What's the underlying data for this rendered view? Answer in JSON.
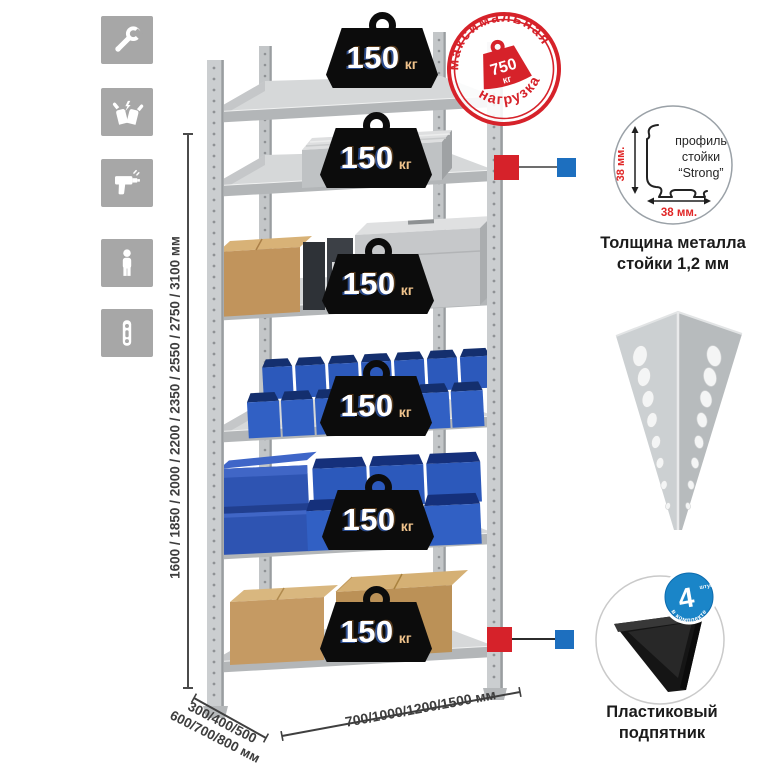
{
  "sidebar": {
    "icons": [
      "wrench-icon",
      "gloves-icon",
      "drill-icon",
      "person-icon",
      "rack-post-icon"
    ]
  },
  "dimensions": {
    "height_label": "1600 / 1850 / 2000 / 2200 / 2350 / 2550 / 2750 / 3100 мм",
    "depth_label_line1": "300/400/500",
    "depth_label_line2": "600/700/800 мм",
    "width_label": "700/1000/1200/1500 мм"
  },
  "rack": {
    "shelves": 6,
    "weights": [
      {
        "value": "150",
        "unit": "кг"
      },
      {
        "value": "150",
        "unit": "кг"
      },
      {
        "value": "150",
        "unit": "кг"
      },
      {
        "value": "150",
        "unit": "кг"
      },
      {
        "value": "150",
        "unit": "кг"
      },
      {
        "value": "150",
        "unit": "кг"
      }
    ]
  },
  "stamp": {
    "arc_top": "максимальная",
    "arc_bottom": "нагрузка",
    "value": "750",
    "unit": "кг"
  },
  "profile_detail": {
    "label_line1": "профиль",
    "label_line2": "стойки",
    "label_line3": "“Strong”",
    "dim_vertical": "38 мм.",
    "dim_horizontal": "38 мм.",
    "caption_line1": "Толщина металла",
    "caption_line2": "стойки 1,2 мм"
  },
  "foot_detail": {
    "badge_value": "4",
    "badge_unit": "штуки",
    "badge_arc": "в комплекте",
    "caption_line1": "Пластиковый",
    "caption_line2": "подпятник"
  },
  "colors": {
    "accent_red": "#d6222a",
    "accent_blue": "#1d6fbf",
    "bin_blue": "#2c59bb",
    "metal_gray": "#c9cbcd",
    "icon_bg": "#a7a7a7"
  }
}
